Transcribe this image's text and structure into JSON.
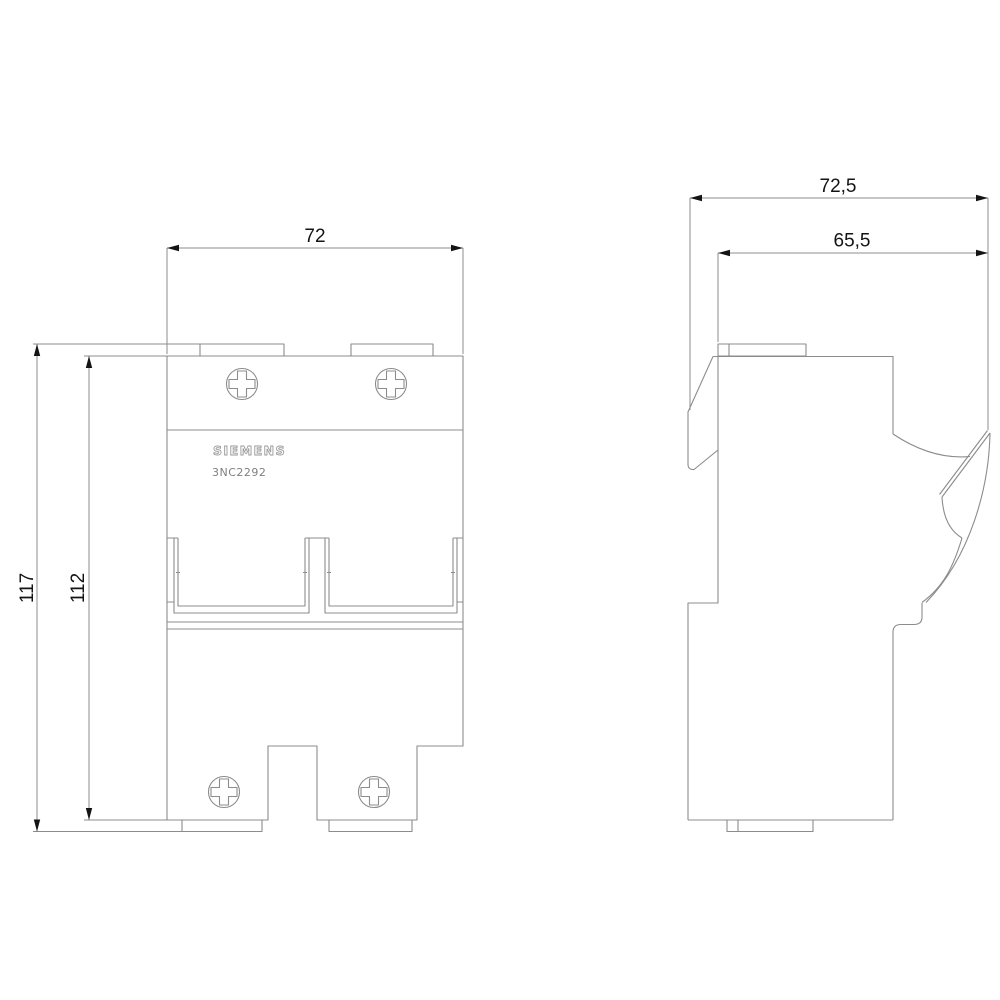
{
  "colors": {
    "background": "#ffffff",
    "line": "#8c8c8c",
    "dim_line": "#8c8c8c",
    "text": "#141414",
    "logo": "#9a9a9a",
    "model_text": "#7f7f7f"
  },
  "front_view": {
    "brand_label": "SIEMENS",
    "model_label": "3NC2292",
    "dim_width": "72",
    "dim_overall_height": "117",
    "dim_body_height": "112"
  },
  "side_view": {
    "dim_overall_depth": "72,5",
    "dim_body_depth": "65,5"
  }
}
